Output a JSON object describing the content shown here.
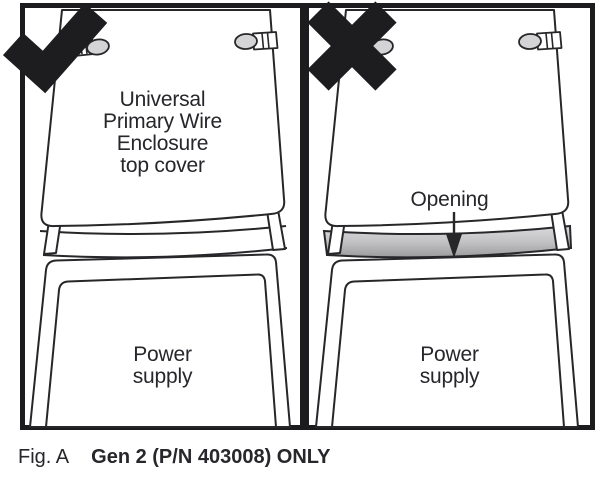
{
  "colors": {
    "line": "#27272a",
    "frame": "#1c1c1e",
    "marker": "#1d1d20",
    "latch": "#d4d4d6",
    "opening-top": "#dadadc",
    "opening-mid": "#c3c3c5",
    "opening-bottom": "#9b9b9d",
    "text": "#26262b"
  },
  "panels": {
    "left": {
      "marker_icon": "check-icon",
      "cover_label": "Universal\nPrimary Wire\nEnclosure\ntop cover",
      "device_label": "Power\nsupply"
    },
    "right": {
      "marker_icon": "cross-icon",
      "opening_label": "Opening",
      "device_label": "Power\nsupply"
    }
  },
  "caption": {
    "figure_label": "Fig. A",
    "text": "Gen 2 (P/N 403008) ONLY"
  }
}
